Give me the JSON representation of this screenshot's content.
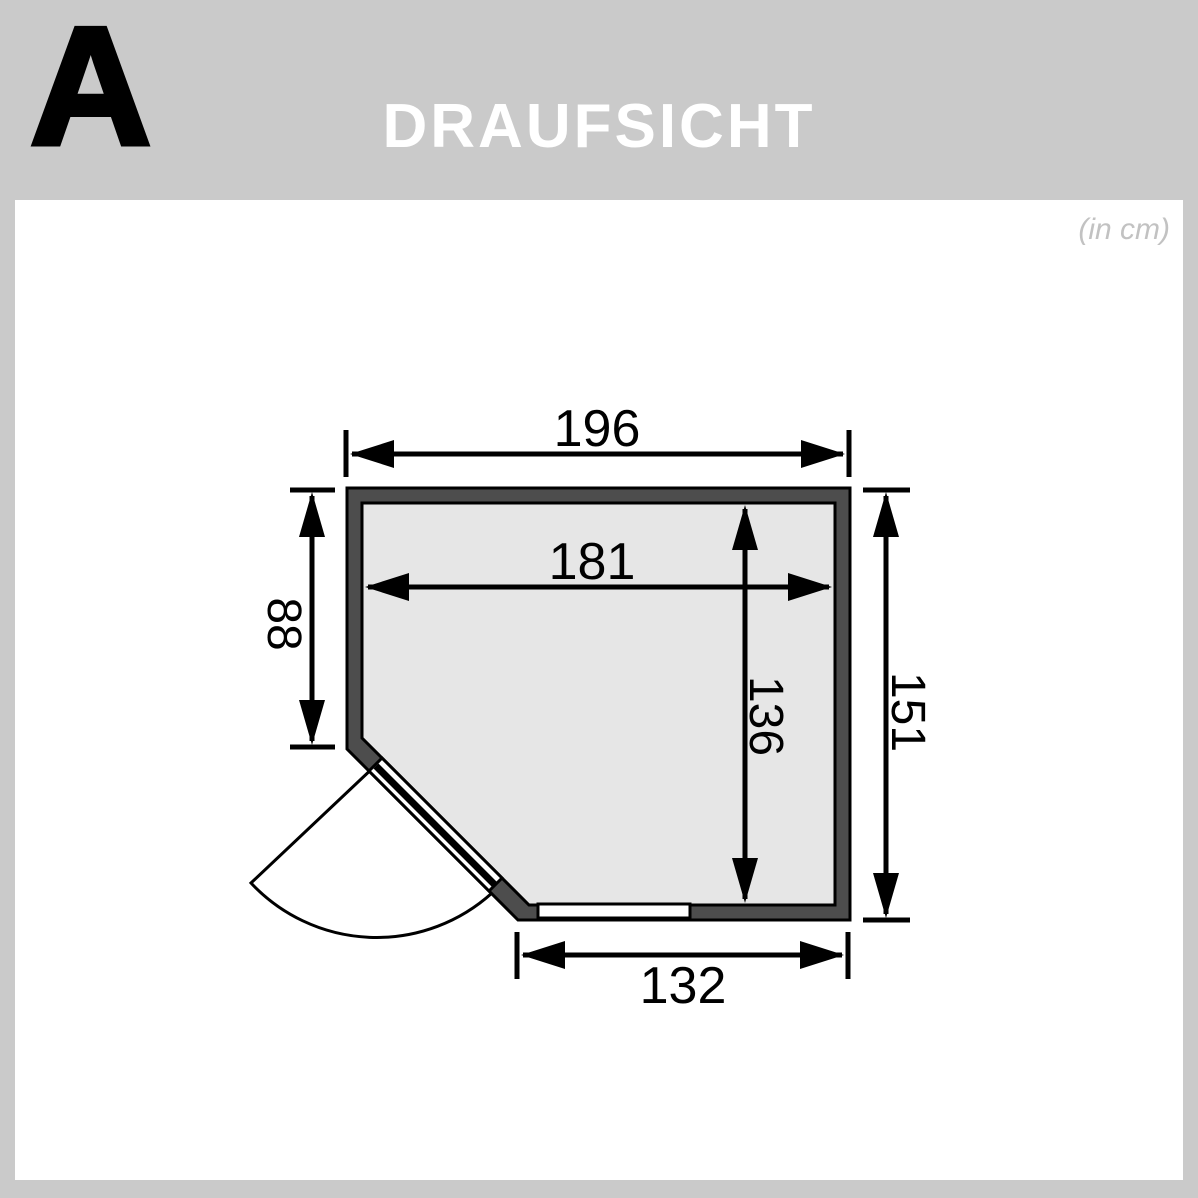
{
  "page": {
    "variant_letter": "A",
    "title": "DRAUFSICHT",
    "units_note": "(in cm)"
  },
  "colors": {
    "frame_gray": "#cacaca",
    "wall_dark": "#4d4d4d",
    "floor_light": "#e6e6e6",
    "door_white": "#ffffff",
    "outline_black": "#000000",
    "title_text": "#ffffff",
    "units_text": "#c2c2c2"
  },
  "floor_plan": {
    "view": "top view",
    "unit": "cm",
    "dimensions": {
      "outer_width_top": "196",
      "inner_width": "181",
      "left_wall_to_door": "88",
      "inner_depth": "136",
      "outer_depth_right": "151",
      "bottom_width": "132"
    },
    "elements": {
      "door": "corner door with quarter-circle swing arc at bottom-left diagonal",
      "window": "window strip in bottom wall"
    }
  }
}
